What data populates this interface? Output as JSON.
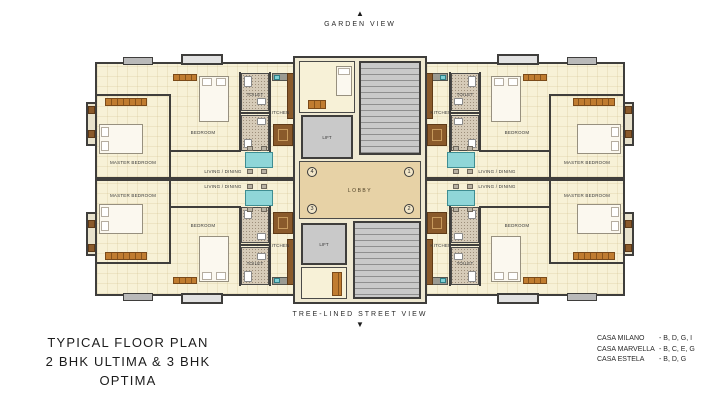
{
  "compass": {
    "top": {
      "arrow": "▲",
      "label": "GARDEN VIEW"
    },
    "bottom": {
      "arrow": "▼",
      "label": "TREE-LINED STREET VIEW"
    }
  },
  "plan": {
    "room_labels": {
      "master": "MASTER BEDROOM",
      "bedroom": "BEDROOM",
      "toilet": "TOILET",
      "kitchen": "KITCHEN",
      "living": "LIVING / DINING",
      "lobby": "LOBBY",
      "lift": "LIFT"
    },
    "unit_numbers": {
      "top_left": "4",
      "top_right": "1",
      "bottom_left": "3",
      "bottom_right": "2"
    }
  },
  "title": {
    "line1": "TYPICAL FLOOR PLAN",
    "line2": "2 BHK ULTIMA & 3 BHK OPTIMA"
  },
  "legend": {
    "items": [
      {
        "name": "CASA MILANO",
        "wings": "- B, D, G, I"
      },
      {
        "name": "CASA MARVELLA",
        "wings": "- B, C, E, G"
      },
      {
        "name": "CASA ESTELA",
        "wings": "- B, D, G"
      }
    ]
  },
  "colors": {
    "wall": "#3f3e3c",
    "floor": "#f7f1d7",
    "lobby": "#e7d2a6",
    "core_gray": "#c9c9c9",
    "accent_teal": "#8fd6d8",
    "wardrobe_orange": "#c07c30",
    "furniture_brown": "#8a5a2b"
  }
}
